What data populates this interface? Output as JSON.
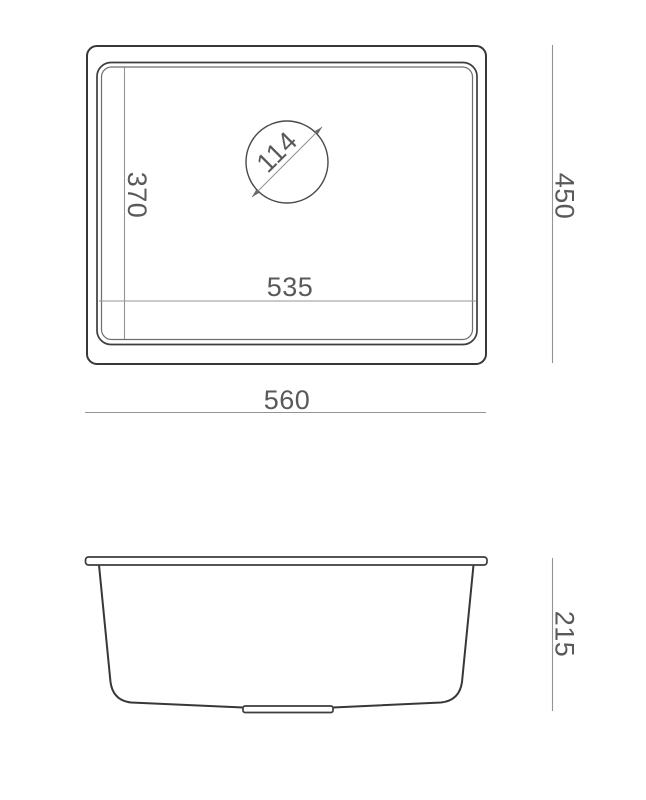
{
  "drawing": {
    "kind": "kitchen-sink-dimension-drawing",
    "top_view": {
      "overall_width": "560",
      "overall_depth": "450",
      "bowl_width": "535",
      "bowl_depth": "370",
      "drain_diameter": "114"
    },
    "side_view": {
      "depth": "215"
    },
    "colors": {
      "background": "#ffffff",
      "outline": "#373737",
      "secondary_outline": "#6e6e6e",
      "dimension_line": "#949494",
      "dimension_text": "#58595b"
    }
  }
}
